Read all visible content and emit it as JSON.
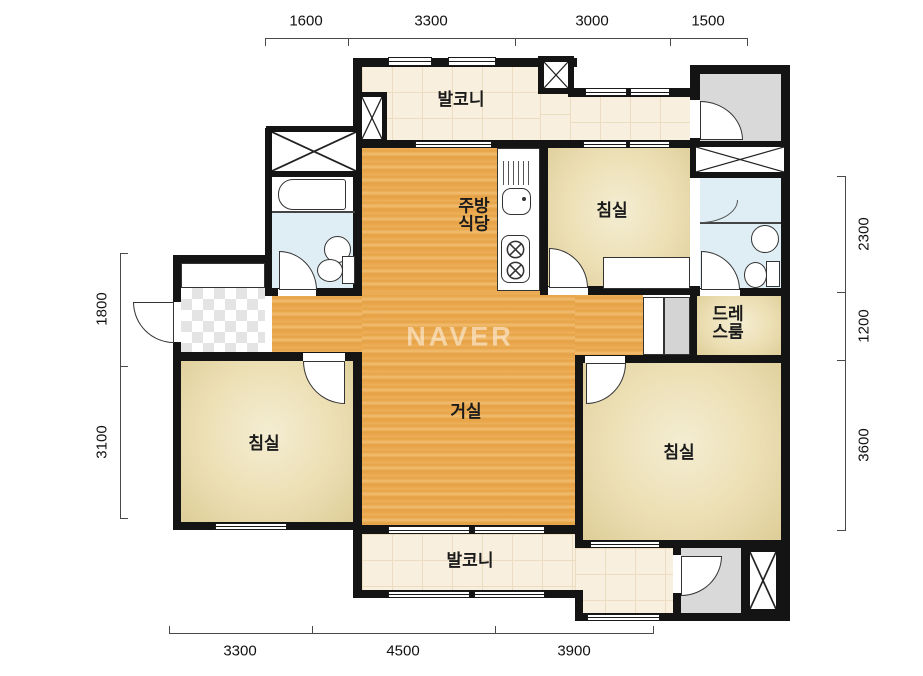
{
  "watermark": "NAVER",
  "rooms": {
    "balcony_top": "발코니",
    "balcony_bottom": "발코니",
    "kitchen": [
      "주방",
      "식당"
    ],
    "bedroom_top": "침실",
    "bedroom_left": "침실",
    "bedroom_right": "침실",
    "living": "거실",
    "dressroom": [
      "드레",
      "스룸"
    ]
  },
  "dimensions": {
    "top": [
      "1600",
      "3300",
      "3000",
      "1500"
    ],
    "bottom": [
      "3300",
      "4500",
      "3900"
    ],
    "left": [
      "1800",
      "3100"
    ],
    "right": [
      "2300",
      "1200",
      "3600"
    ]
  },
  "colors": {
    "wall": "#141414",
    "wood_floor": "#e9a84e",
    "bedroom_floor": "#ead9ac",
    "balcony_floor": "#f9efde",
    "bathroom_floor": "#dfeef4",
    "utility_gray": "#d9d9d9"
  }
}
